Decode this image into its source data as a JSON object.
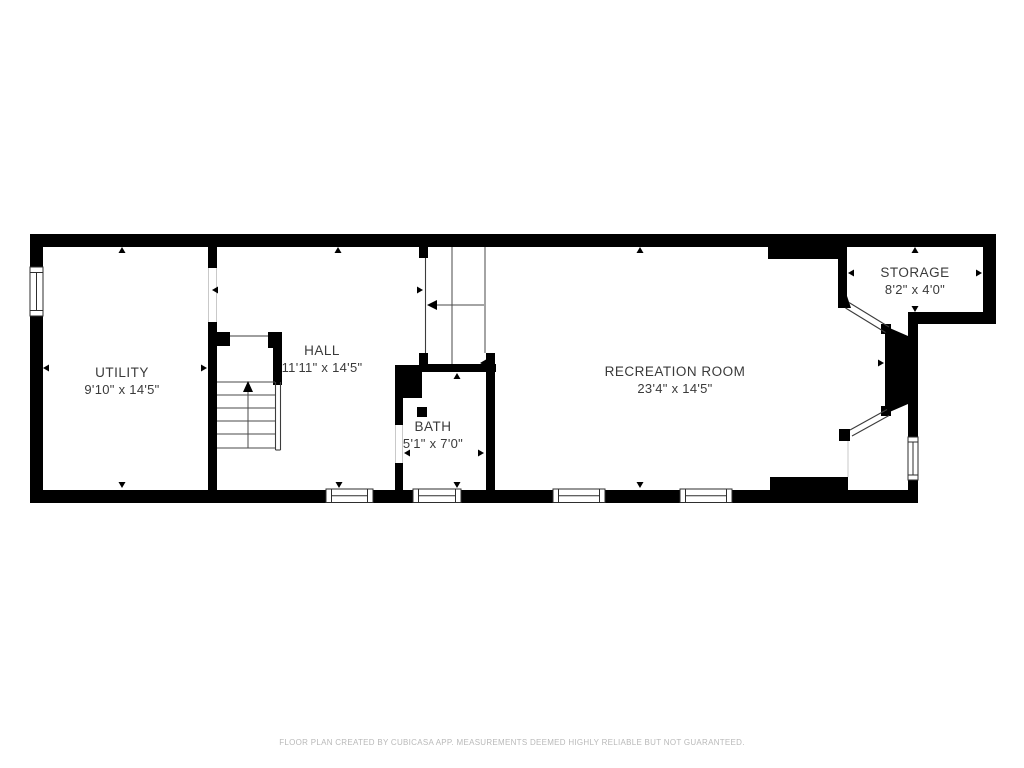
{
  "meta": {
    "footer": "FLOOR PLAN CREATED BY CUBICASA APP. MEASUREMENTS DEEMED HIGHLY RELIABLE BUT NOT GUARANTEED."
  },
  "colors": {
    "wall": "#000000",
    "text": "#3a3a3a",
    "footer_text": "#b9b9b9",
    "background": "#ffffff"
  },
  "rooms": [
    {
      "id": "utility",
      "name": "UTILITY",
      "dims": "9'10\" x 14'5\""
    },
    {
      "id": "hall",
      "name": "HALL",
      "dims": "11'11\" x 14'5\""
    },
    {
      "id": "bath",
      "name": "BATH",
      "dims": "5'1\" x 7'0\""
    },
    {
      "id": "recreation",
      "name": "RECREATION ROOM",
      "dims": "23'4\" x 14'5\""
    },
    {
      "id": "storage",
      "name": "STORAGE",
      "dims": "8'2\" x 4'0\""
    }
  ],
  "stairs": [
    {
      "id": "hall-stairs",
      "direction": "up"
    },
    {
      "id": "upper-stairs",
      "direction": "left"
    }
  ],
  "windows": {
    "count": 6
  },
  "doors": {
    "diagonal_count": 2
  }
}
